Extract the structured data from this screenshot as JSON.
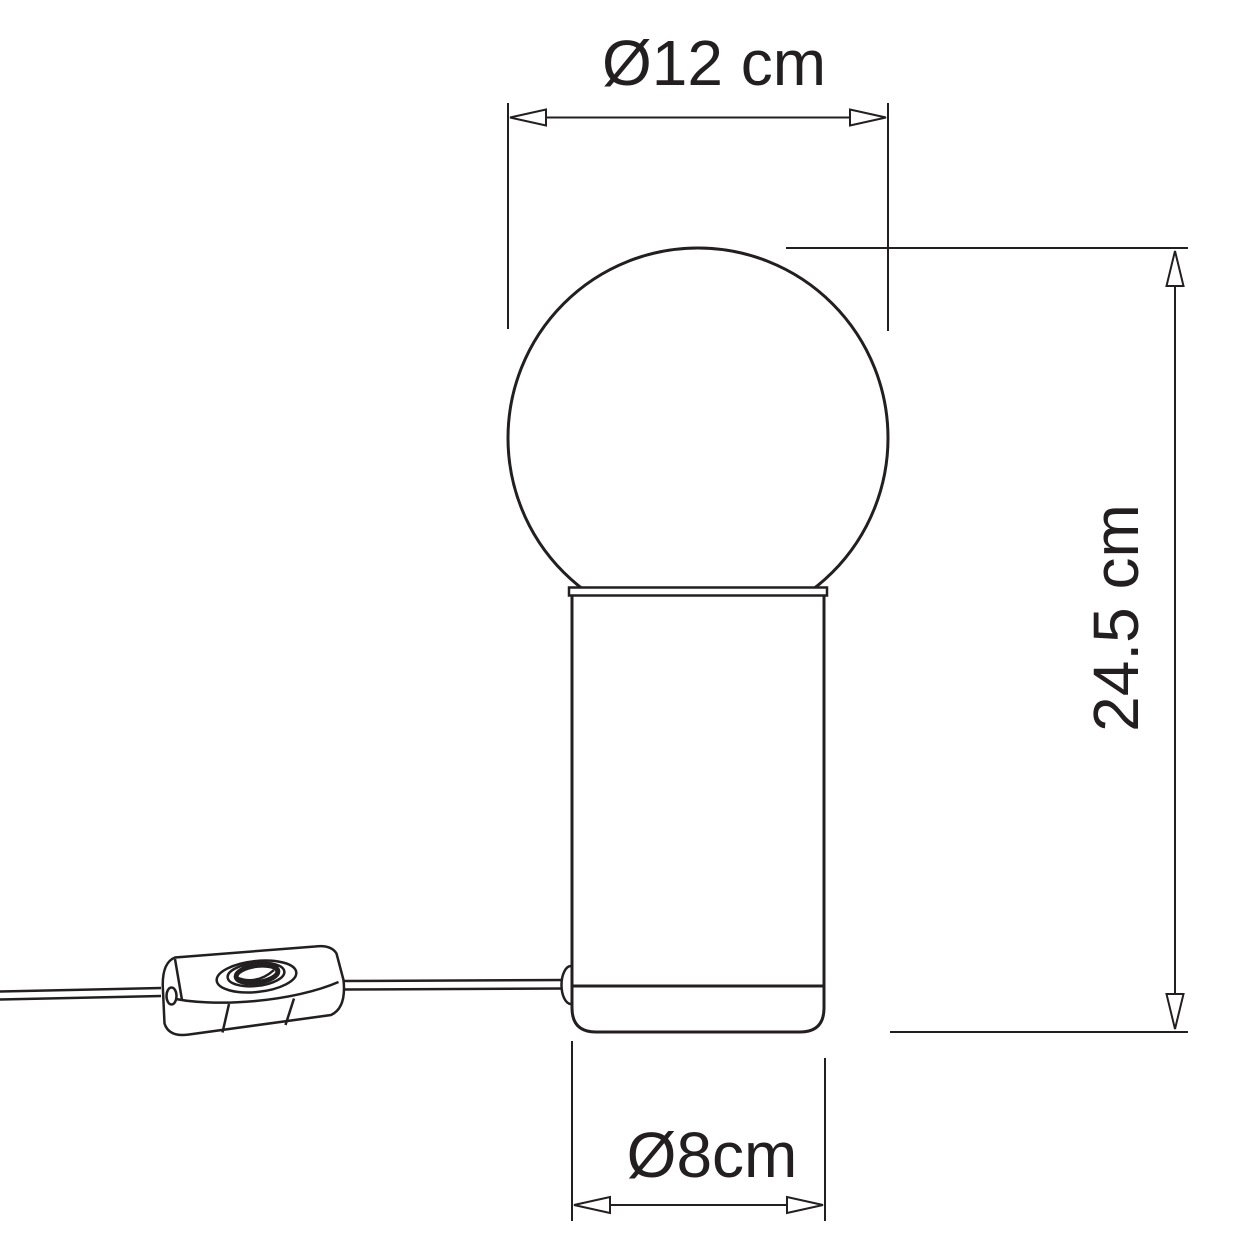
{
  "diagram": {
    "background_color": "#ffffff",
    "line_color": "#231f20",
    "dimensions": [
      {
        "id": "bulb-diameter",
        "label": "Ø12 cm",
        "orientation": "horizontal",
        "position": "top"
      },
      {
        "id": "overall-height",
        "label": "24.5 cm",
        "orientation": "vertical",
        "position": "right"
      },
      {
        "id": "base-diameter",
        "label": "Ø8cm",
        "orientation": "horizontal",
        "position": "bottom"
      }
    ]
  }
}
